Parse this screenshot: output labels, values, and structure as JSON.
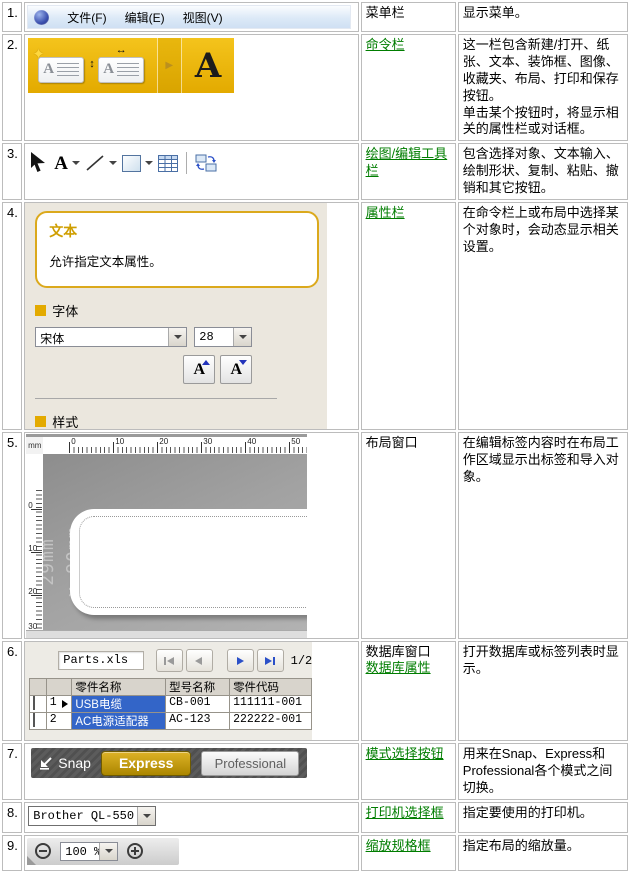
{
  "colors": {
    "link_green": "#007d00",
    "accent_gold": "#e8b400",
    "selection_blue": "#3365c8"
  },
  "rows": {
    "r1": {
      "num": "1.",
      "name": "菜单栏",
      "desc": "显示菜单。"
    },
    "r2": {
      "num": "2.",
      "name": "命令栏",
      "desc1": "这一栏包含新建/打开、纸张、文本、装饰框、图像、收藏夹、布局、打印和保存按钮。",
      "desc2": "单击某个按钮时，将显示相关的属性栏或对话框。"
    },
    "r3": {
      "num": "3.",
      "name": "绘图/编辑工具栏",
      "desc": "包含选择对象、文本输入、绘制形状、复制、粘贴、撤销和其它按钮。"
    },
    "r4": {
      "num": "4.",
      "name": "属性栏",
      "desc": "在命令栏上或布局中选择某个对象时，会动态显示相关设置。"
    },
    "r5": {
      "num": "5.",
      "name": "布局窗口",
      "desc": "在编辑标签内容时在布局工作区域显示出标签和导入对象。"
    },
    "r6": {
      "num": "6.",
      "name_plain": "数据库窗口",
      "name_link": "数据库属性",
      "desc": "打开数据库或标签列表时显示。"
    },
    "r7": {
      "num": "7.",
      "name": "模式选择按钮",
      "desc": "用来在Snap、Express和Professional各个模式之间切换。"
    },
    "r8": {
      "num": "8.",
      "name": "打印机选择框",
      "desc": "指定要使用的打印机。"
    },
    "r9": {
      "num": "9.",
      "name": "缩放规格框",
      "desc": "指定布局的缩放量。"
    }
  },
  "menu_bar": {
    "items": [
      "文件(F)",
      "编辑(E)",
      "视图(V)"
    ]
  },
  "command_bar": {
    "text_button": "A",
    "arrow": "▶",
    "h_arrow": "↔",
    "v_arrow": "↕",
    "star": "✦"
  },
  "draw_toolbar": {
    "text_tool": "A"
  },
  "properties_panel": {
    "title": "文本",
    "tooltip": "允许指定文本属性。",
    "font_section": "字体",
    "font_name": "宋体",
    "font_size": "28",
    "style_section": "样式",
    "bold": "B",
    "italic": "I",
    "underline": "U",
    "outline": "A"
  },
  "layout_window": {
    "unit": "mm",
    "h_ticks": [
      "0",
      "10",
      "20",
      "30",
      "40",
      "50"
    ],
    "v_ticks": [
      "0",
      "10",
      "20",
      "30"
    ],
    "tape_size_line1": "29mm",
    "tape_size_line2": "x 90mm"
  },
  "database": {
    "filename": "Parts.xls",
    "page": "1/2",
    "headers": [
      "零件名称",
      "型号名称",
      "零件代码"
    ],
    "records": [
      {
        "num": "1",
        "name": "USB电缆",
        "model": "CB-001",
        "code": "111111-001"
      },
      {
        "num": "2",
        "name": "AC电源适配器",
        "model": "AC-123",
        "code": "222222-001"
      }
    ]
  },
  "mode_switcher": {
    "snap": "Snap",
    "express": "Express",
    "professional": "Professional"
  },
  "printer_select": {
    "value": "Brother QL-550"
  },
  "zoom_control": {
    "value": "100 %"
  }
}
